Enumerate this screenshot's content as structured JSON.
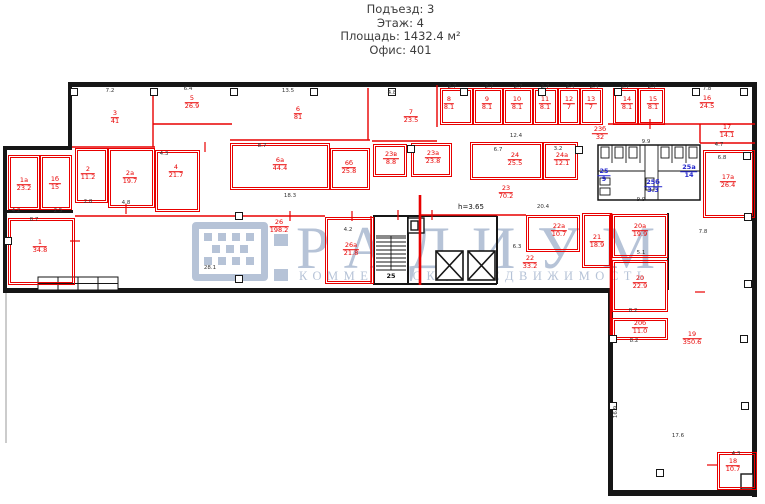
{
  "header": {
    "lines": [
      "Подъезд: 3",
      "Этаж: 4",
      "Площадь: 1432.4 м²",
      "Офис: 401"
    ]
  },
  "watermark": {
    "brand": "РАДИУМ",
    "tagline": "КОММЕРЧЕСКАЯ НЕДВИЖИМОСТЬ",
    "color": "#b6c3d7"
  },
  "plan": {
    "colors": {
      "room_outline": "#e80000",
      "wet_zone": "#2326cc",
      "walls": "#161616"
    },
    "rooms": [
      {
        "n": "1",
        "a": "34.8",
        "box": [
          8,
          218,
          67,
          67
        ],
        "lx": 40,
        "ly": 247
      },
      {
        "n": "1а",
        "a": "23.2",
        "box": [
          8,
          155,
          32,
          55
        ],
        "lx": 24,
        "ly": 185
      },
      {
        "n": "1б",
        "a": "15",
        "box": [
          40,
          155,
          32,
          55
        ],
        "lx": 55,
        "ly": 184
      },
      {
        "n": "2",
        "a": "11.2",
        "box": [
          75,
          148,
          33,
          55
        ],
        "lx": 88,
        "ly": 174
      },
      {
        "n": "2а",
        "a": "19.7",
        "box": [
          108,
          148,
          47,
          60
        ],
        "lx": 130,
        "ly": 178
      },
      {
        "n": "3",
        "a": "41",
        "lx": 115,
        "ly": 118
      },
      {
        "n": "4",
        "a": "21.7",
        "box": [
          155,
          150,
          45,
          62
        ],
        "lx": 176,
        "ly": 172
      },
      {
        "n": "5",
        "a": "26.9",
        "lx": 192,
        "ly": 103
      },
      {
        "n": "6",
        "a": "81",
        "lx": 298,
        "ly": 114
      },
      {
        "n": "6а",
        "a": "44.4",
        "box": [
          230,
          143,
          100,
          47
        ],
        "lx": 280,
        "ly": 165
      },
      {
        "n": "6б",
        "a": "25.8",
        "box": [
          330,
          148,
          40,
          42
        ],
        "lx": 349,
        "ly": 168
      },
      {
        "n": "7",
        "a": "23.5",
        "lx": 411,
        "ly": 117
      },
      {
        "n": "8",
        "a": "8.1",
        "box": [
          440,
          88,
          33,
          37
        ],
        "lx": 449,
        "ly": 104
      },
      {
        "n": "9",
        "a": "8.1",
        "box": [
          473,
          88,
          30,
          37
        ],
        "lx": 487,
        "ly": 104
      },
      {
        "n": "10",
        "a": "8.1",
        "box": [
          503,
          88,
          30,
          37
        ],
        "lx": 517,
        "ly": 104
      },
      {
        "n": "11",
        "a": "8.1",
        "box": [
          533,
          88,
          25,
          37
        ],
        "lx": 545,
        "ly": 104
      },
      {
        "n": "12",
        "a": "7",
        "box": [
          558,
          88,
          22,
          37
        ],
        "lx": 569,
        "ly": 104
      },
      {
        "n": "13",
        "a": "7",
        "box": [
          580,
          88,
          23,
          37
        ],
        "lx": 591,
        "ly": 104
      },
      {
        "n": "14",
        "a": "8.1",
        "box": [
          613,
          88,
          25,
          37
        ],
        "lx": 627,
        "ly": 104
      },
      {
        "n": "15",
        "a": "8.1",
        "box": [
          638,
          88,
          27,
          37
        ],
        "lx": 653,
        "ly": 104
      },
      {
        "n": "16",
        "a": "24.5",
        "lx": 707,
        "ly": 103
      },
      {
        "n": "17",
        "a": "14.1",
        "lx": 727,
        "ly": 132
      },
      {
        "n": "17а",
        "a": "26.4",
        "box": [
          703,
          150,
          52,
          68
        ],
        "lx": 728,
        "ly": 182
      },
      {
        "n": "18",
        "a": "10.7",
        "box": [
          717,
          452,
          40,
          38
        ],
        "lx": 733,
        "ly": 466
      },
      {
        "n": "19",
        "a": "350.6",
        "lx": 692,
        "ly": 339
      },
      {
        "n": "20",
        "a": "22.9",
        "box": [
          612,
          260,
          56,
          52
        ],
        "lx": 640,
        "ly": 283
      },
      {
        "n": "20а",
        "a": "19.9",
        "box": [
          612,
          214,
          56,
          44
        ],
        "lx": 640,
        "ly": 231
      },
      {
        "n": "20б",
        "a": "11.0",
        "box": [
          612,
          318,
          56,
          22
        ],
        "lx": 640,
        "ly": 328
      },
      {
        "n": "21",
        "a": "18.9",
        "box": [
          582,
          213,
          30,
          55
        ],
        "lx": 597,
        "ly": 242
      },
      {
        "n": "22",
        "a": "33.2",
        "lx": 530,
        "ly": 263
      },
      {
        "n": "22а",
        "a": "10.7",
        "box": [
          526,
          215,
          54,
          37
        ],
        "lx": 559,
        "ly": 231
      },
      {
        "n": "23",
        "a": "70.2",
        "lx": 506,
        "ly": 193
      },
      {
        "n": "23а",
        "a": "23.8",
        "box": [
          411,
          143,
          41,
          34
        ],
        "lx": 433,
        "ly": 158
      },
      {
        "n": "23б",
        "a": "32",
        "lx": 600,
        "ly": 134
      },
      {
        "n": "23в",
        "a": "8.8",
        "box": [
          373,
          144,
          34,
          33
        ],
        "lx": 391,
        "ly": 159
      },
      {
        "n": "24",
        "a": "25.5",
        "box": [
          470,
          142,
          73,
          38
        ],
        "lx": 515,
        "ly": 160
      },
      {
        "n": "24а",
        "a": "12.1",
        "box": [
          543,
          142,
          35,
          38
        ],
        "lx": 562,
        "ly": 160
      },
      {
        "n": "25",
        "a": "9",
        "c": "blue",
        "lx": 604,
        "ly": 176
      },
      {
        "n": "25а",
        "a": "14",
        "c": "blue",
        "lx": 689,
        "ly": 172
      },
      {
        "n": "25б",
        "a": "3.3",
        "c": "blue",
        "lx": 653,
        "ly": 187
      },
      {
        "n": "26",
        "a": "198.2",
        "lx": 279,
        "ly": 227
      },
      {
        "n": "26а",
        "a": "21.8",
        "box": [
          325,
          217,
          49,
          67
        ],
        "lx": 351,
        "ly": 250
      }
    ],
    "dims": [
      {
        "t": "7.2",
        "x": 110,
        "y": 91
      },
      {
        "t": "13.5",
        "x": 288,
        "y": 91
      },
      {
        "t": "6.4",
        "x": 188,
        "y": 89
      },
      {
        "t": "4.8",
        "x": 392,
        "y": 93
      },
      {
        "t": "2.7",
        "x": 452,
        "y": 87
      },
      {
        "t": "2.7",
        "x": 489,
        "y": 87
      },
      {
        "t": "2.7",
        "x": 518,
        "y": 87
      },
      {
        "t": "2.7",
        "x": 545,
        "y": 87
      },
      {
        "t": "2.4",
        "x": 570,
        "y": 87
      },
      {
        "t": "2.4",
        "x": 594,
        "y": 87
      },
      {
        "t": "2.7",
        "x": 625,
        "y": 87
      },
      {
        "t": "2.7",
        "x": 652,
        "y": 87
      },
      {
        "t": "7.8",
        "x": 707,
        "y": 89
      },
      {
        "t": "8.7",
        "x": 262,
        "y": 146
      },
      {
        "t": "12.4",
        "x": 516,
        "y": 136
      },
      {
        "t": "6.7",
        "x": 498,
        "y": 150
      },
      {
        "t": "3.2",
        "x": 558,
        "y": 149
      },
      {
        "t": "9.9",
        "x": 646,
        "y": 142
      },
      {
        "t": "4.7",
        "x": 719,
        "y": 145
      },
      {
        "t": "6.8",
        "x": 722,
        "y": 158
      },
      {
        "t": "18.3",
        "x": 290,
        "y": 196
      },
      {
        "t": "9.9",
        "x": 641,
        "y": 200
      },
      {
        "t": "20.4",
        "x": 543,
        "y": 207
      },
      {
        "t": "6.3",
        "x": 517,
        "y": 247
      },
      {
        "t": "5.1",
        "x": 641,
        "y": 253
      },
      {
        "t": "28.1",
        "x": 210,
        "y": 268
      },
      {
        "t": "8.2",
        "x": 633,
        "y": 311
      },
      {
        "t": "8.2",
        "x": 634,
        "y": 341
      },
      {
        "t": "7.8",
        "x": 703,
        "y": 232
      },
      {
        "t": "17.6",
        "x": 678,
        "y": 436
      },
      {
        "t": "16.9",
        "x": 616,
        "y": 412,
        "r": 1
      },
      {
        "t": "4.3",
        "x": 736,
        "y": 454
      },
      {
        "t": "8.7",
        "x": 34,
        "y": 220
      },
      {
        "t": "4.2",
        "x": 16,
        "y": 211
      },
      {
        "t": "2.5",
        "x": 58,
        "y": 211
      },
      {
        "t": "2.8",
        "x": 88,
        "y": 202
      },
      {
        "t": "4.8",
        "x": 126,
        "y": 203
      },
      {
        "t": "4.3",
        "x": 164,
        "y": 154
      },
      {
        "t": "4.2",
        "x": 348,
        "y": 230
      },
      {
        "t": "h=3.65",
        "x": 471,
        "y": 207,
        "k": "note"
      },
      {
        "t": "25",
        "x": 391,
        "y": 276,
        "k": "stair"
      }
    ],
    "columns": [
      [
        70,
        88
      ],
      [
        150,
        88
      ],
      [
        230,
        88
      ],
      [
        310,
        88
      ],
      [
        388,
        88
      ],
      [
        460,
        88
      ],
      [
        538,
        88
      ],
      [
        614,
        88
      ],
      [
        692,
        88
      ],
      [
        740,
        88
      ],
      [
        235,
        212
      ],
      [
        235,
        275
      ],
      [
        4,
        237
      ],
      [
        407,
        145
      ],
      [
        575,
        146
      ],
      [
        743,
        152
      ],
      [
        744,
        213
      ],
      [
        744,
        280
      ],
      [
        740,
        335
      ],
      [
        609,
        335
      ],
      [
        609,
        402
      ],
      [
        741,
        402
      ],
      [
        656,
        469
      ]
    ]
  }
}
